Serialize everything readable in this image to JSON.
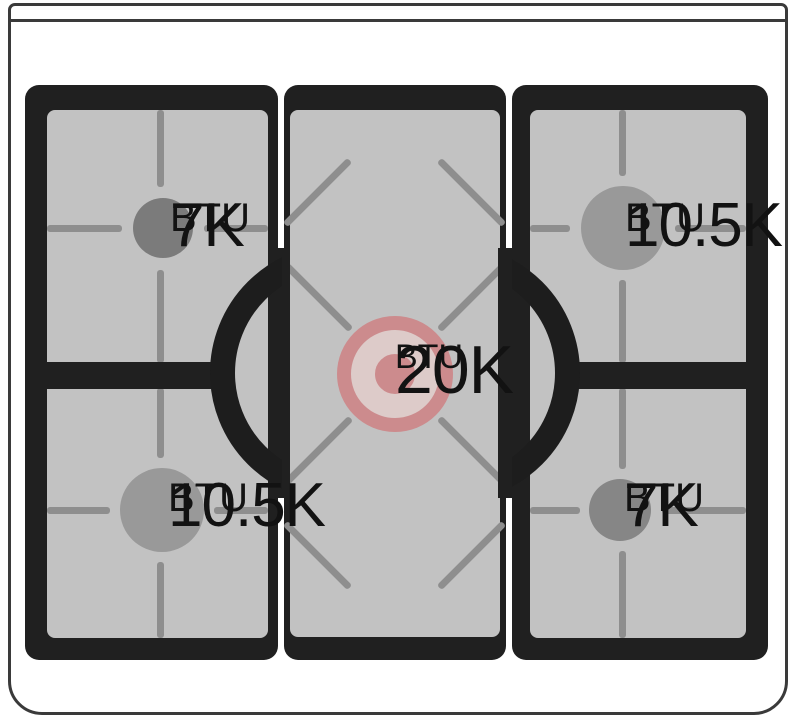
{
  "diagram": {
    "type": "gas-rangetop-burner-power-diagram",
    "burners": {
      "top_left": {
        "power": "7K",
        "unit": "BTU",
        "cap_color": "#7b7b7b"
      },
      "top_right": {
        "power": "10.5K",
        "unit": "BTU",
        "cap_color": "#999999"
      },
      "center": {
        "power": "20K",
        "unit": "BTU",
        "cap_color": "#cc8b8d",
        "highlighted": true
      },
      "bottom_left": {
        "power": "10.5K",
        "unit": "BTU",
        "cap_color": "#999999"
      },
      "bottom_right": {
        "power": "7K",
        "unit": "BTU",
        "cap_color": "#868686"
      }
    },
    "colors": {
      "outline": "#3a3a3a",
      "grate_frame_black": "#202020",
      "surface_gray": "#c2c2c2",
      "grate_line_gray": "#8e8e8e",
      "highlight_pink": "#cc8b8d",
      "highlight_inner_ring": "#ddcbc9",
      "label_text": "#121212"
    }
  }
}
